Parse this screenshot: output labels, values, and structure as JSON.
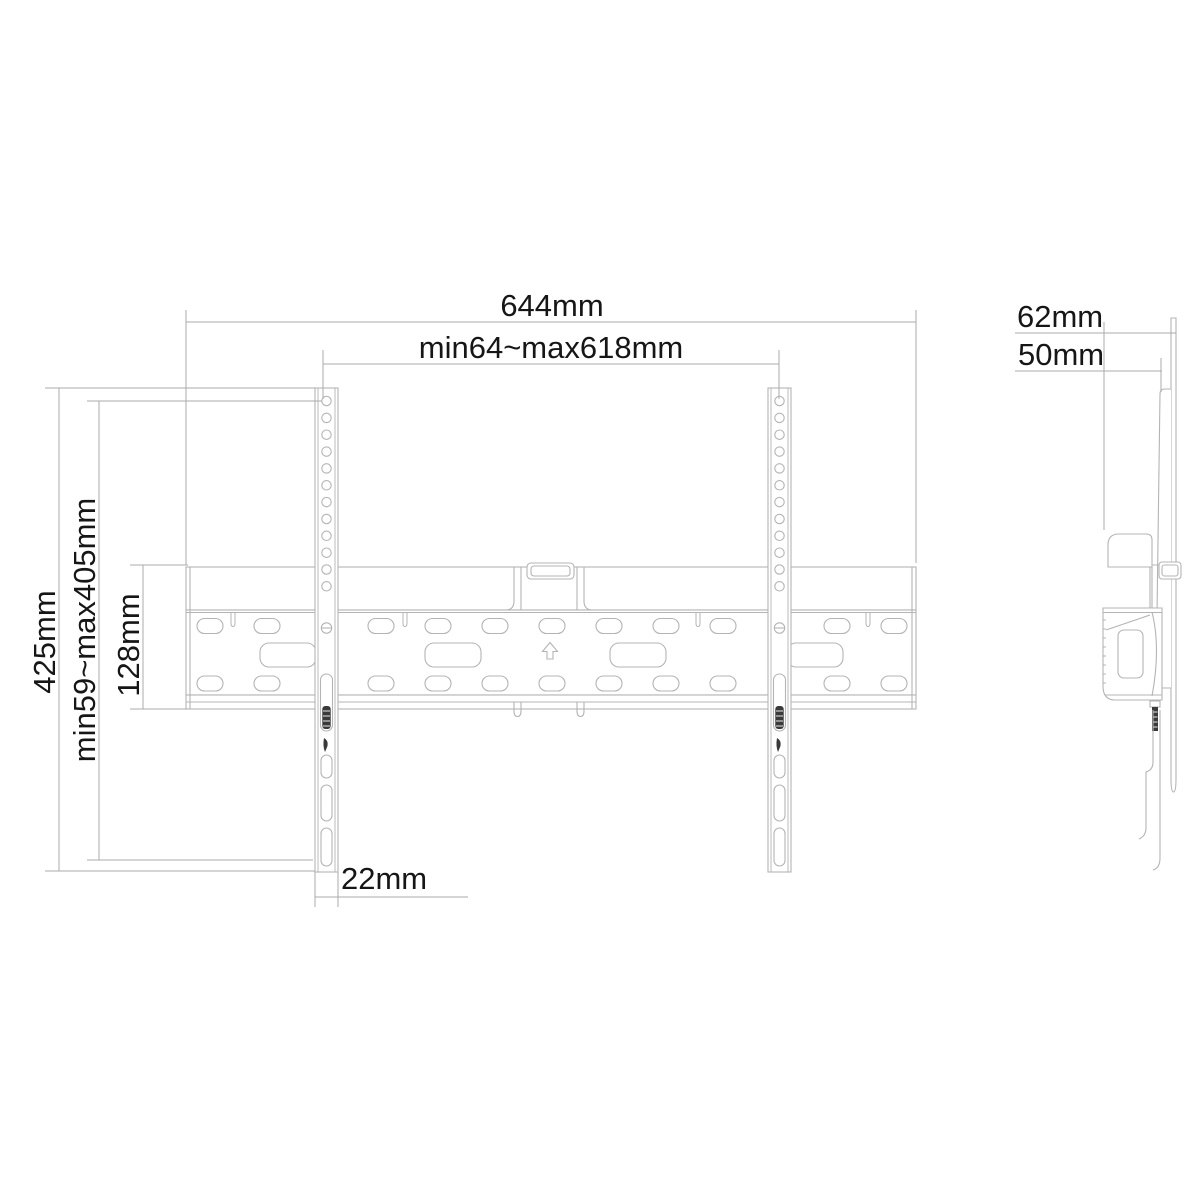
{
  "drawing": {
    "type": "technical-drawing",
    "subject": "TV wall mount bracket - front and side orthographic views with dimensions",
    "background_color": "#ffffff",
    "line_color": "#b4b4b4",
    "text_color": "#161616",
    "screw_color": "#3a3a3a",
    "front_view": {
      "labels": {
        "total_width": "644mm",
        "vesa_width_range": "min64~max618mm",
        "total_height": "425mm",
        "vesa_height_range": "min59~max405mm",
        "wall_plate_height": "128mm",
        "rail_width": "22mm"
      }
    },
    "side_view": {
      "labels": {
        "total_depth": "62mm",
        "plate_depth": "50mm"
      }
    }
  }
}
